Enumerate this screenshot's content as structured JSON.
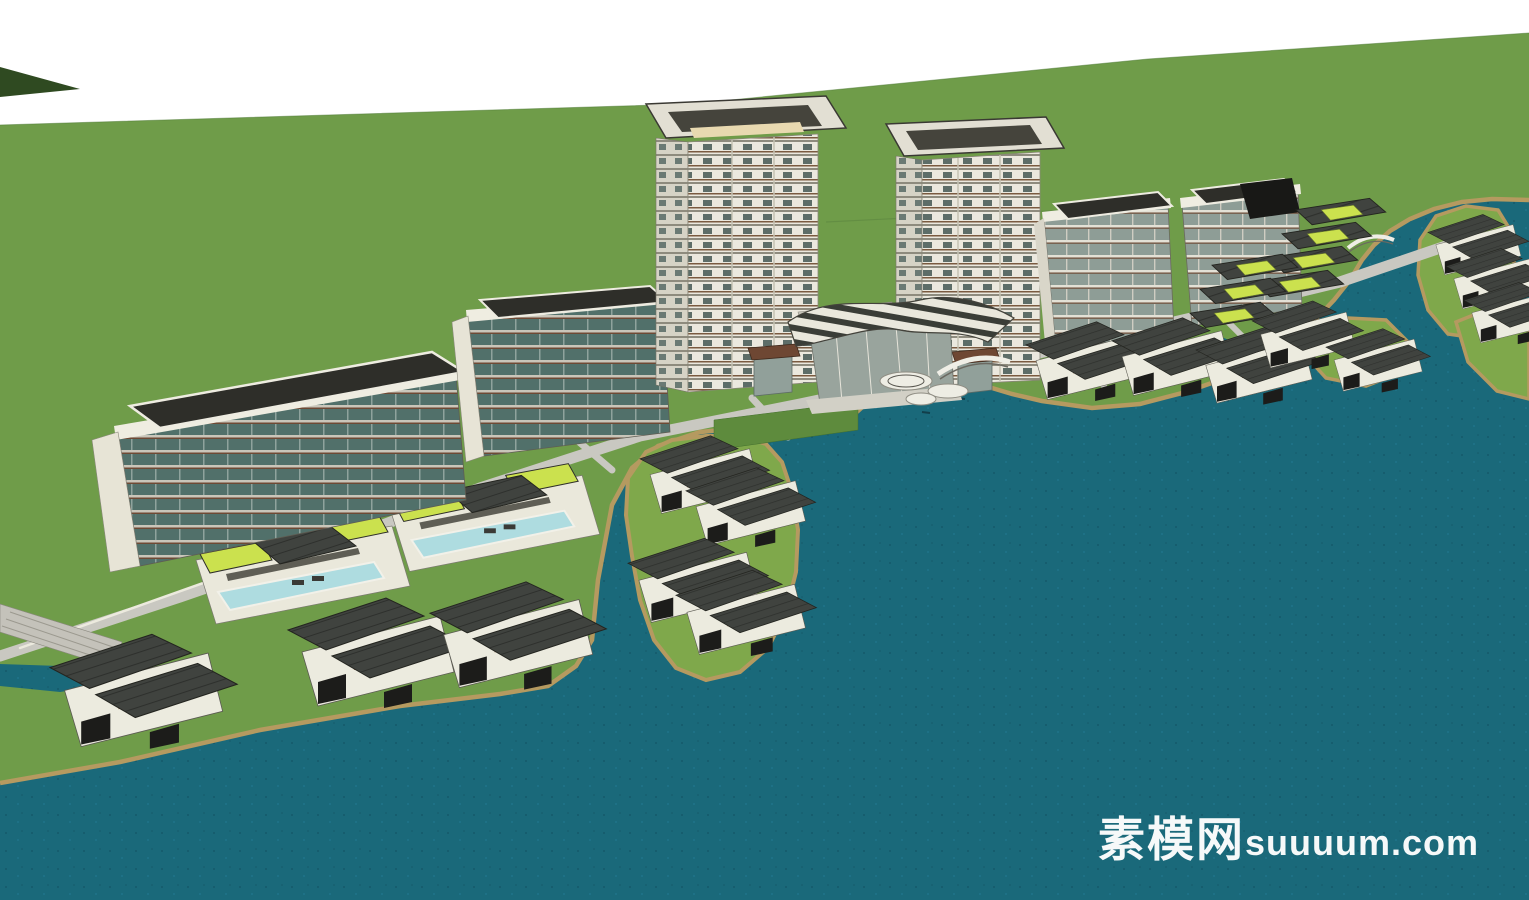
{
  "watermark": {
    "brand_cjk": "素模网",
    "brand_latin": "suuuum.com",
    "color": "#ffffff"
  },
  "scene": {
    "type": "3d-architectural-model-render",
    "style": "sketchup-waterfront-residential-masterplan",
    "view": "aerial-isometric",
    "colors": {
      "background_white": "#ffffff",
      "field_green": "#6f9c49",
      "lawn_green": "#7fa84b",
      "dark_green": "#2f4a21",
      "wall_green": "#5e8b3d",
      "water_teal": "#1a697a",
      "shore_tan": "#b59a60",
      "road_grey": "#c9c8c1",
      "building_white": "#ecebdf",
      "building_shadow": "#d9d6c9",
      "glass_dark_teal": "#51706a",
      "glass_grey": "#8e9d96",
      "roof_dark_grey": "#40433f",
      "roof_lime_green": "#cbe14e",
      "pool_cyan": "#aedce0",
      "wood_brown": "#6e4733",
      "watermark_white": "#ffffff"
    },
    "inventory": {
      "highrise_towers": 2,
      "midrise_apartment_slabs": 2,
      "east_midrise_blocks": 2,
      "terraced_pool_villa_rows": 2,
      "west_shore_villas": 3,
      "island_villas": 4,
      "east_shore_villas": 5,
      "far_island_villas": 4,
      "hillside_terrace_rows": 7,
      "clubhouse": 1,
      "arched_bridges": 2,
      "round_pond_platforms": 3
    }
  }
}
